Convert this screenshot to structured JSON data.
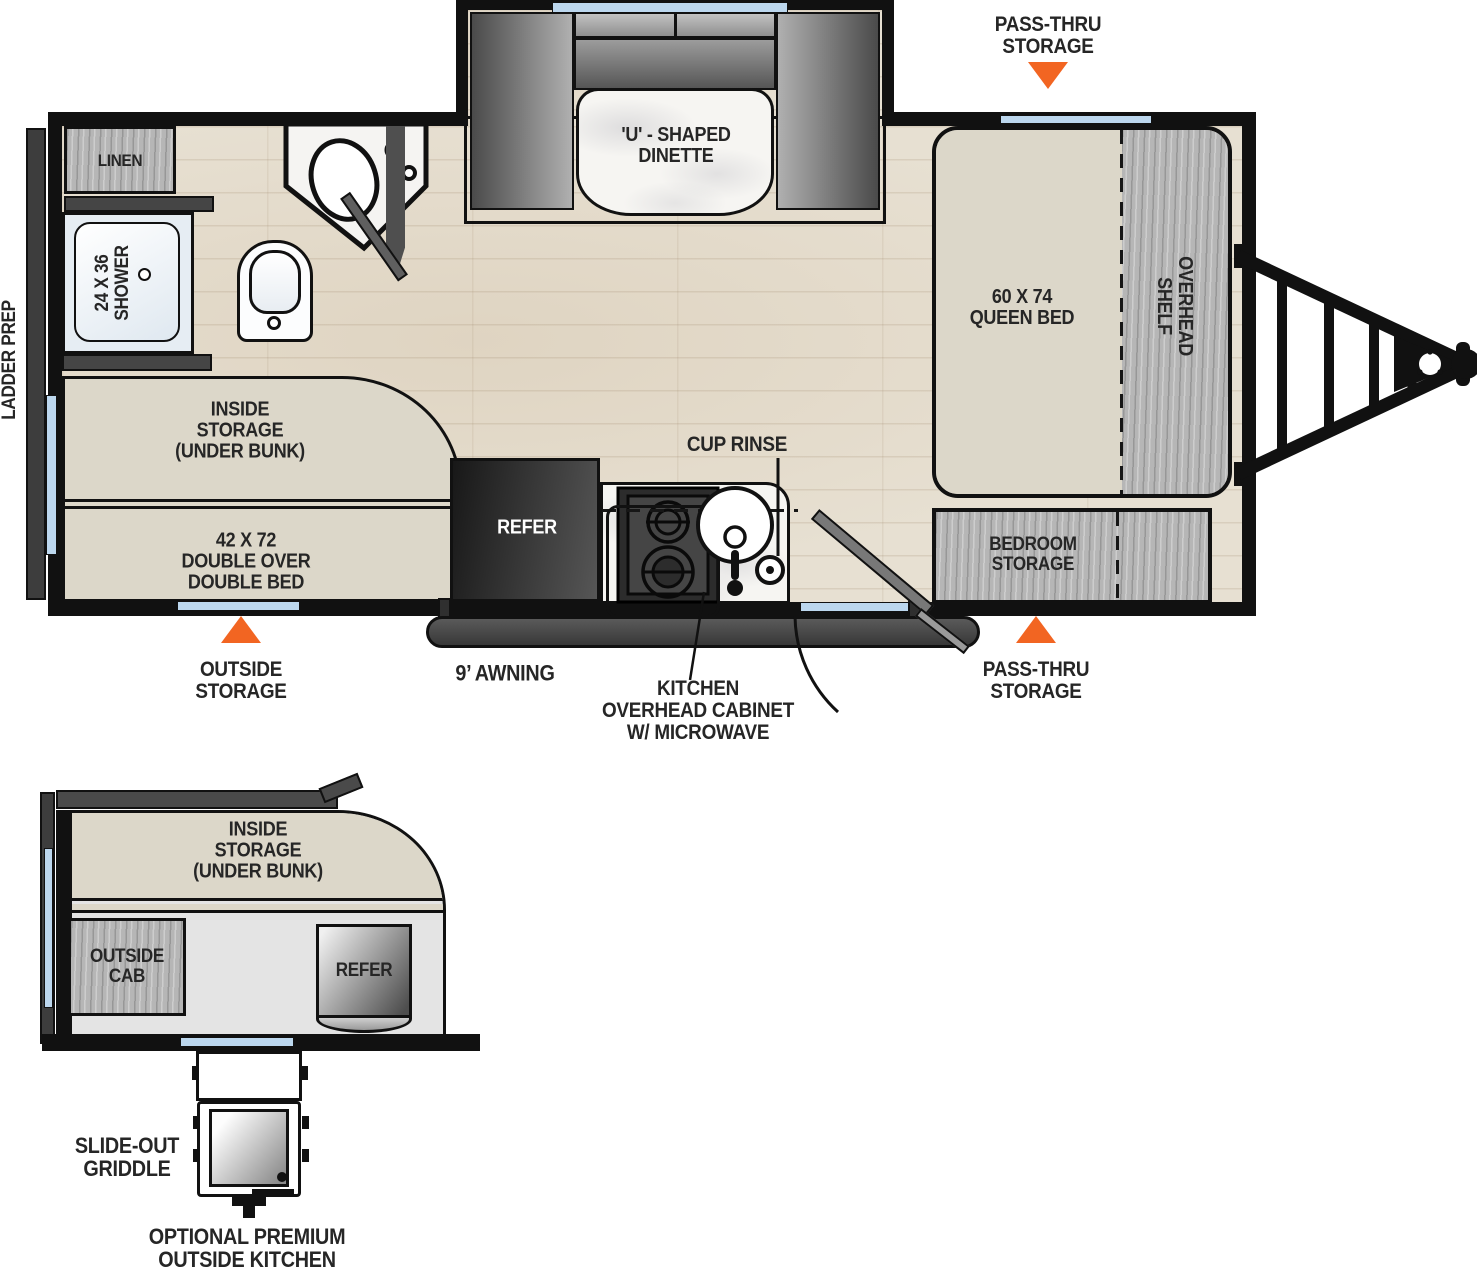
{
  "colors": {
    "accent_orange": "#F26522",
    "window_blue": "#BCD7EE",
    "wall_black": "#111111",
    "bed_beige": "#DCD7C9",
    "cabinet_gray": "#B6B6B6"
  },
  "main": {
    "pass_thru_top": "PASS-THRU\nSTORAGE",
    "pass_thru_bottom": "PASS-THRU\nSTORAGE",
    "outside_storage": "OUTSIDE\nSTORAGE",
    "awning": "9’ AWNING",
    "cup_rinse": "CUP RINSE",
    "kitchen_overhead": "KITCHEN\nOVERHEAD CABINET\nW/ MICROWAVE",
    "ladder_prep": "LADDER PREP",
    "linen": "LINEN",
    "shower": "24 X 36\nSHOWER",
    "dinette": "'U' - SHAPED\nDINETTE",
    "queen_bed": "60 X 74\nQUEEN BED",
    "overhead_shelf": "OVERHEAD\nSHELF",
    "bedroom_storage": "BEDROOM\nSTORAGE",
    "inside_storage": "INSIDE\nSTORAGE\n(UNDER BUNK)",
    "double_bed": "42 X 72\nDOUBLE OVER\nDOUBLE BED",
    "refer": "REFER"
  },
  "detail": {
    "inside_storage": "INSIDE\nSTORAGE\n(UNDER BUNK)",
    "outside_cab": "OUTSIDE\nCAB",
    "refer": "REFER",
    "slide_out_griddle": "SLIDE-OUT\nGRIDDLE",
    "optional_outside_kitchen": "OPTIONAL PREMIUM\nOUTSIDE KITCHEN"
  }
}
